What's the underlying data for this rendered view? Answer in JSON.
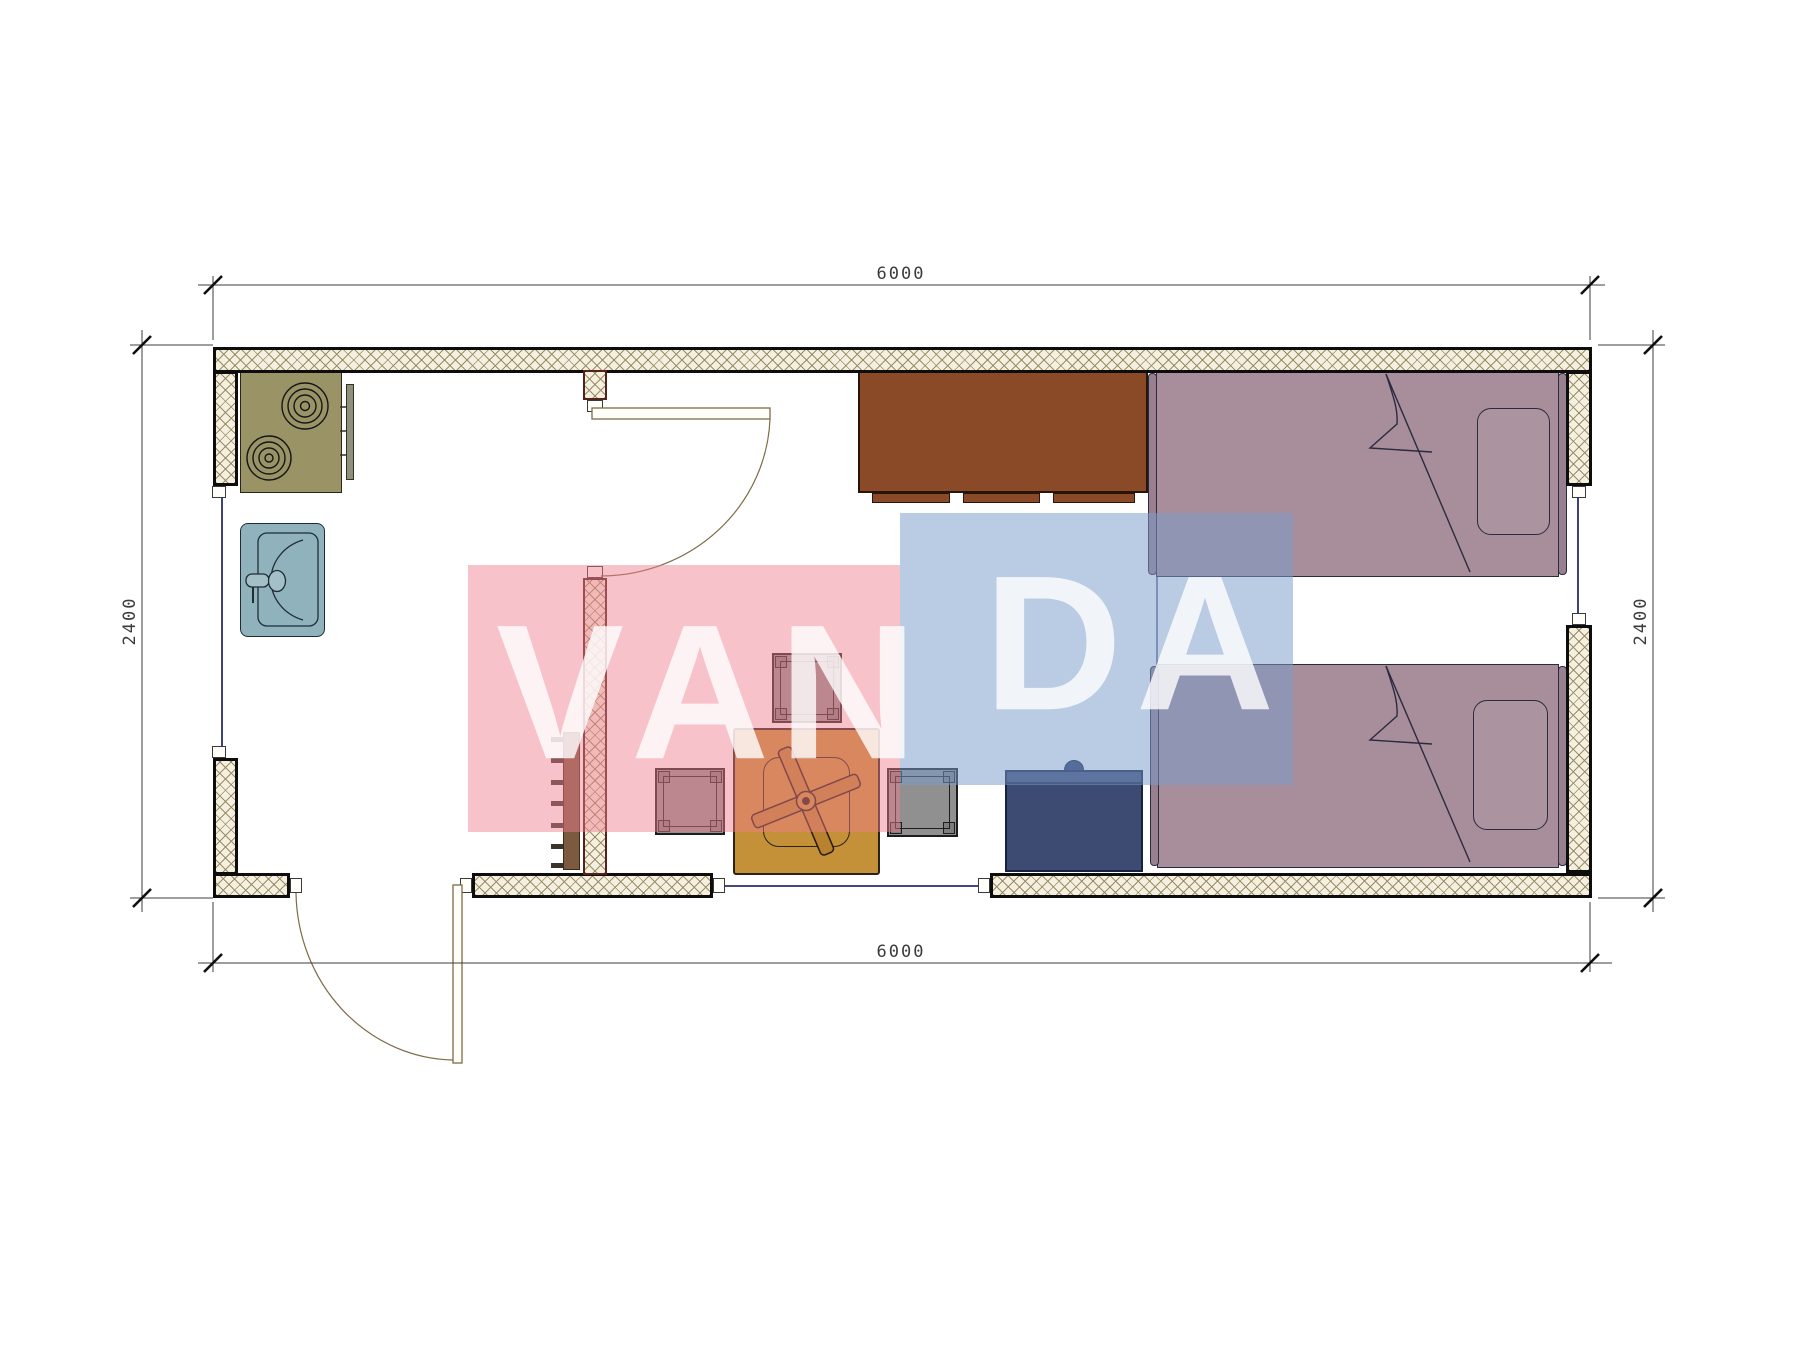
{
  "plan": {
    "dimensions": {
      "top": "6000",
      "bottom": "6000",
      "left": "2400",
      "right": "2400"
    },
    "watermark": {
      "letters": [
        "V",
        "A",
        "N",
        "D",
        "A"
      ],
      "pink_color": "#EE7D8C",
      "blue_color": "#7A9CCC",
      "letter_color": "#FFFFFF"
    },
    "colors": {
      "wall_hatch_bg": "#F4EFDF",
      "wall_outline": "#0D0D0D",
      "partition_outline": "#55221A",
      "stove": "#999366",
      "sink": "#8FB2BC",
      "cabinet_brown": "#8A4A27",
      "bed_mauve": "#A78E9A",
      "wardrobe_navy": "#3D4A72",
      "table_orange": "#C49038",
      "stool_gray": "#909090",
      "door_line": "#7D6C46",
      "window_glazing": "#282E6E"
    }
  }
}
